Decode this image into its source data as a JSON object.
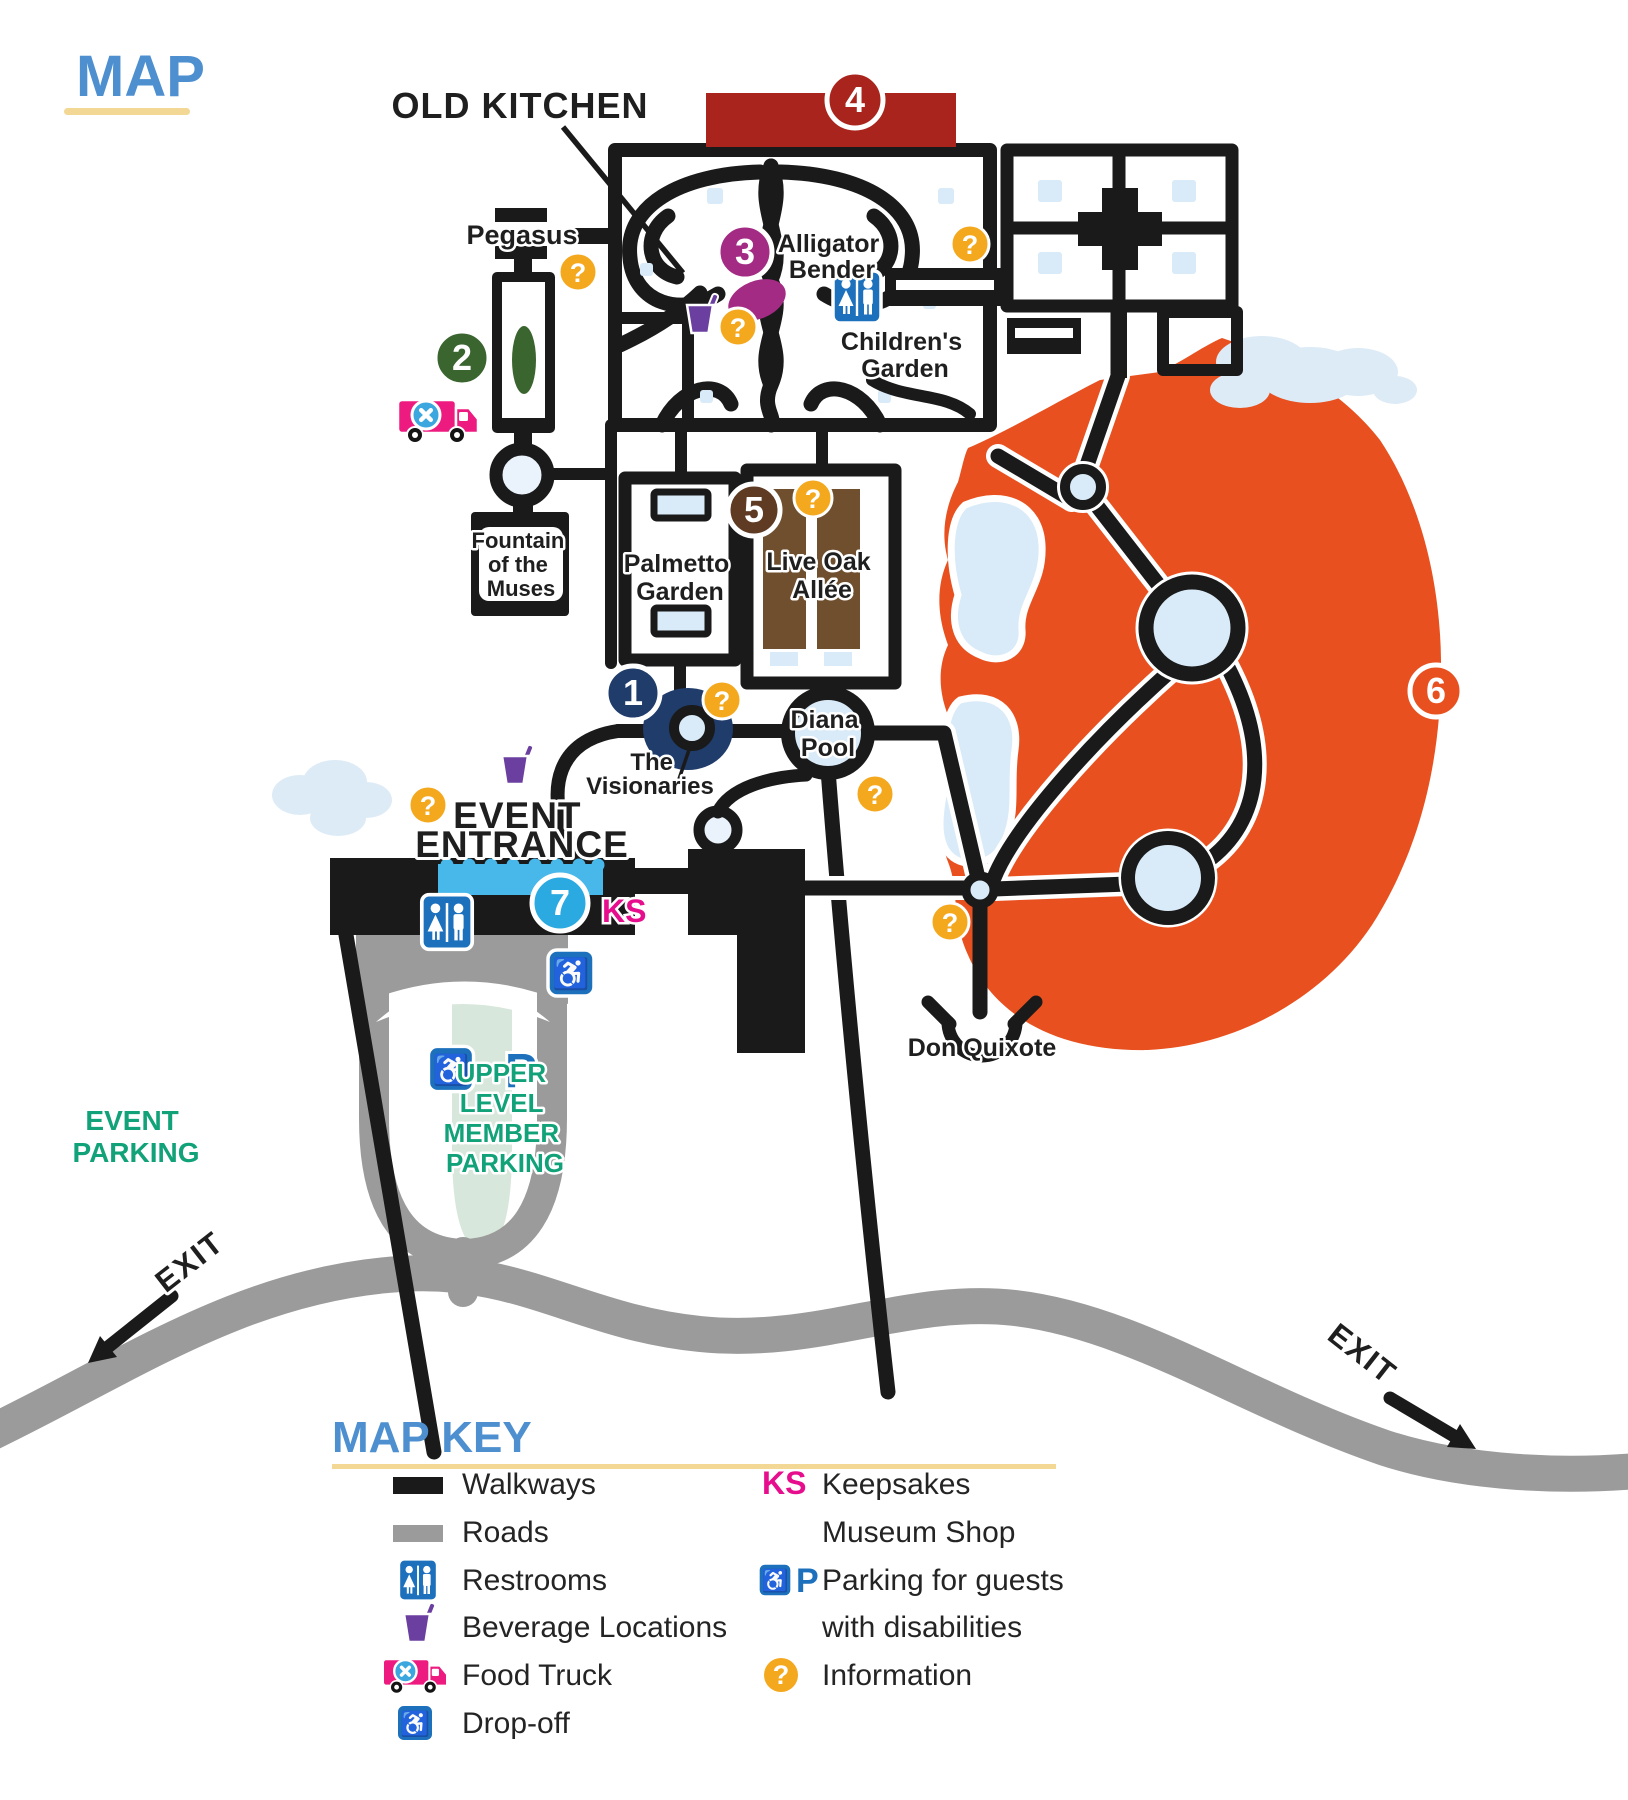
{
  "title": {
    "text": "MAP"
  },
  "map": {
    "labels": {
      "old_kitchen": "OLD KITCHEN",
      "pegasus": "Pegasus",
      "alligator_bender": [
        "Alligator",
        "Bender"
      ],
      "childrens_garden": [
        "Children's",
        "Garden"
      ],
      "fountain_of_the_muses": [
        "Fountain",
        "of the",
        "Muses"
      ],
      "palmetto_garden": [
        "Palmetto",
        "Garden"
      ],
      "live_oak_allee": [
        "Live Oak",
        "Allée"
      ],
      "diana_pool": [
        "Diana",
        "Pool"
      ],
      "the_visionaries": [
        "The",
        "Visionaries"
      ],
      "event_entrance": [
        "EVENT",
        "ENTRANCE"
      ],
      "don_quixote": "Don Quixote",
      "upper_level_member_parking": [
        "UPPER",
        "LEVEL",
        "MEMBER",
        "PARKING"
      ],
      "event_parking": [
        "EVENT",
        "PARKING"
      ],
      "exit_left": "EXIT",
      "exit_right": "EXIT",
      "ks": "KS"
    },
    "markers": [
      {
        "number": "1",
        "color": "#1F3C6B"
      },
      {
        "number": "2",
        "color": "#3A652F"
      },
      {
        "number": "3",
        "color": "#A32B84"
      },
      {
        "number": "4",
        "color": "#A8241C"
      },
      {
        "number": "5",
        "color": "#5E3B22"
      },
      {
        "number": "6",
        "color": "#E8511F"
      },
      {
        "number": "7",
        "color": "#2BA9E1"
      }
    ],
    "info_glyph": "?",
    "parking_p": "P"
  },
  "key": {
    "title": "MAP KEY",
    "walkways": "Walkways",
    "roads": "Roads",
    "restrooms": "Restrooms",
    "beverage": "Beverage Locations",
    "food_truck": "Food Truck",
    "drop_off": "Drop-off",
    "ks_symbol": "KS",
    "keepsakes": "Keepsakes",
    "museum_shop": "Museum Shop",
    "parking_line1": "Parking for guests",
    "parking_line2": "with disabilities",
    "information": "Information",
    "parking_p": "P"
  },
  "colors": {
    "walkway": "#1A1A1A",
    "road": "#9C9B9B",
    "water": "#D9EAF8",
    "cloud": "#DDEBF7",
    "sculpture_zone_orange": "#E8511F",
    "heading_blue": "#4E8FD0",
    "underline_yellow": "#F2D795",
    "parking_green": "#12A279",
    "ks_magenta": "#E60E8C",
    "info_orange": "#F4A81D",
    "icon_blue": "#1D70BC",
    "beverage_purple": "#6B3FA0",
    "truck_pink": "#ED1A7F",
    "allee_brown": "#6F4F2E",
    "pegasus_green": "#3A652F",
    "red_bar": "#A8241C",
    "member_strip_green": "#D8E7DB"
  }
}
